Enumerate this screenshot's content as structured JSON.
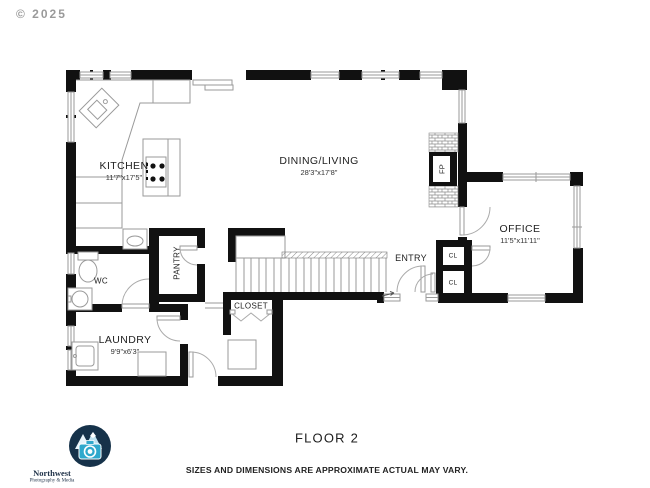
{
  "copyright": "© 2025",
  "rooms": {
    "kitchen": {
      "name": "KITCHEN",
      "dims": "11'7\"x17'5\""
    },
    "dining_living": {
      "name": "DINING/LIVING",
      "dims": "28'3\"x17'8\""
    },
    "office": {
      "name": "OFFICE",
      "dims": "11'5\"x11'11\""
    },
    "laundry": {
      "name": "LAUNDRY",
      "dims": "9'9\"x6'3\""
    },
    "wc": {
      "name": "WC"
    },
    "pantry": {
      "name": "PANTRY"
    },
    "entry": {
      "name": "ENTRY"
    },
    "closet": {
      "name": "CLOSET"
    },
    "closet_upper": {
      "name": "CL"
    },
    "closet_lower": {
      "name": "CL"
    },
    "fireplace": {
      "name": "FP"
    }
  },
  "footer": {
    "floor_title": "FLOOR 2",
    "disclaimer": "SIZES AND DIMENSIONS ARE APPROXIMATE ACTUAL MAY VARY."
  },
  "logo": {
    "line1": "Northwest",
    "line2": "Photography & Media"
  },
  "colors": {
    "wall": "#111111",
    "line": "#9a9a9a",
    "text": "#2a2a2a",
    "navy": "#16324a",
    "teal": "#2fa8cc"
  }
}
